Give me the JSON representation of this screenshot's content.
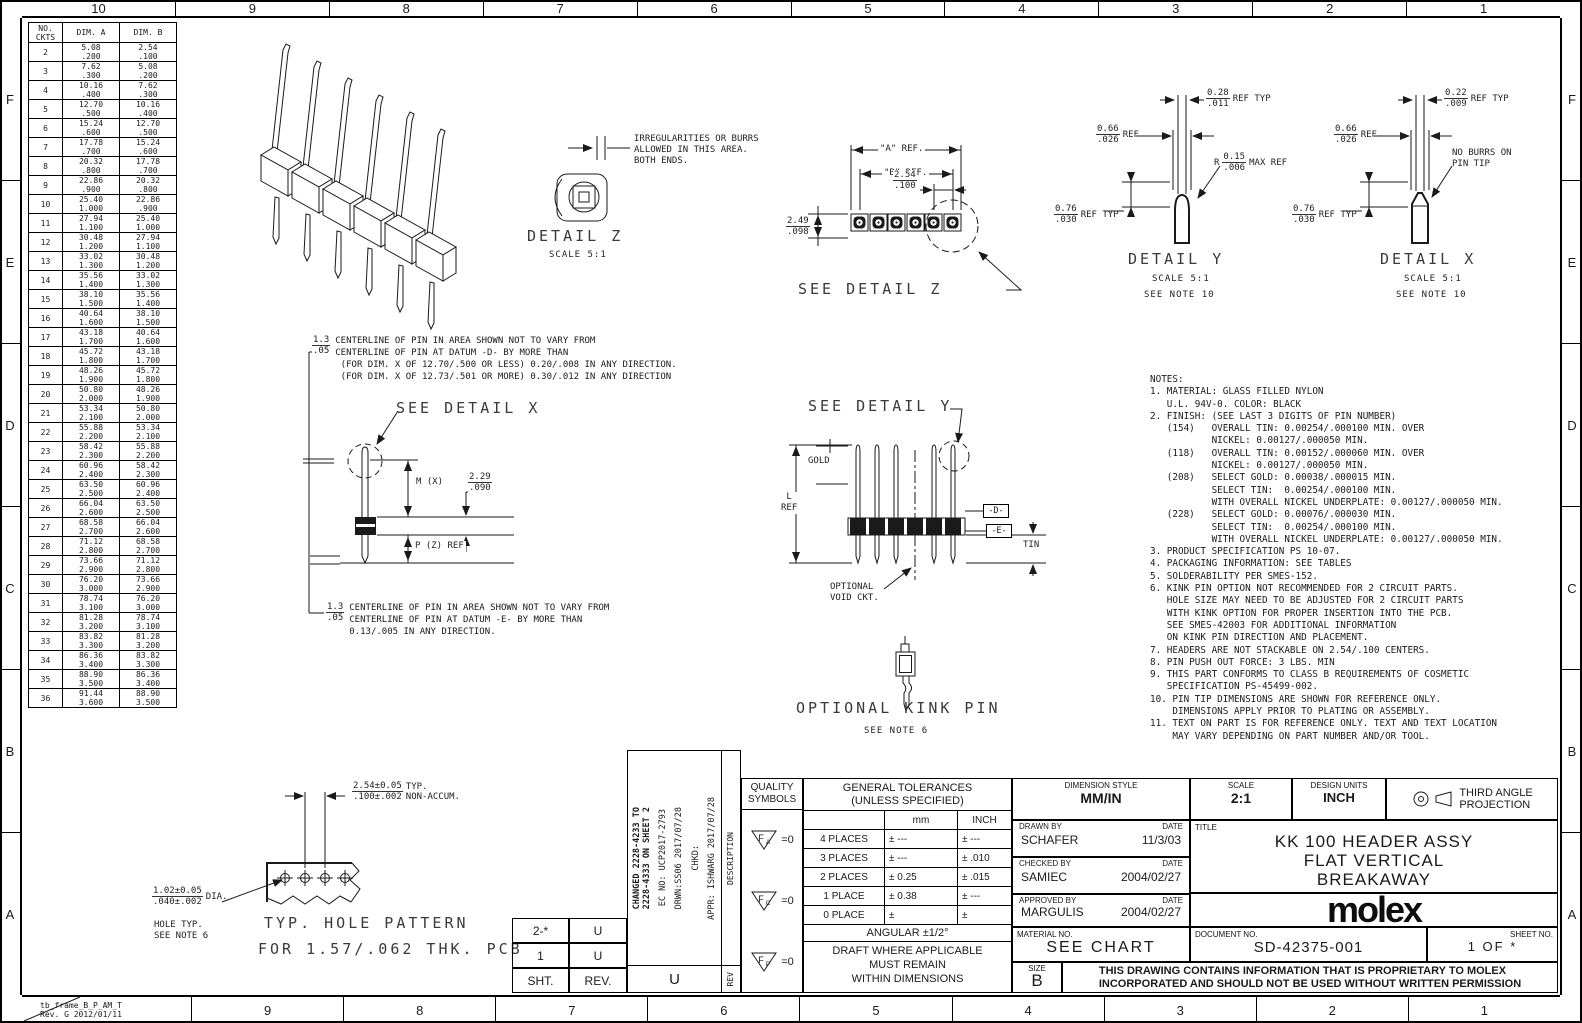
{
  "frame": {
    "top": [
      "10",
      "9",
      "8",
      "7",
      "6",
      "5",
      "4",
      "3",
      "2",
      "1"
    ],
    "bottom": [
      "9",
      "8",
      "7",
      "6",
      "5",
      "4",
      "3",
      "2",
      "1"
    ],
    "side": [
      "F",
      "E",
      "D",
      "C",
      "B",
      "A"
    ],
    "stamp": "tb_frame_B_P_AM_T\nRev. G 2012/01/11"
  },
  "circuits_table": {
    "col_ckts": "NO.\nCKTS",
    "col_a": "DIM. A",
    "col_b": "DIM. B",
    "rows": [
      [
        "2",
        "5.08",
        ".200",
        "2.54",
        ".100"
      ],
      [
        "3",
        "7.62",
        ".300",
        "5.08",
        ".200"
      ],
      [
        "4",
        "10.16",
        ".400",
        "7.62",
        ".300"
      ],
      [
        "5",
        "12.70",
        ".500",
        "10.16",
        ".400"
      ],
      [
        "6",
        "15.24",
        ".600",
        "12.70",
        ".500"
      ],
      [
        "7",
        "17.78",
        ".700",
        "15.24",
        ".600"
      ],
      [
        "8",
        "20.32",
        ".800",
        "17.78",
        ".700"
      ],
      [
        "9",
        "22.86",
        ".900",
        "20.32",
        ".800"
      ],
      [
        "10",
        "25.40",
        "1.000",
        "22.86",
        ".900"
      ],
      [
        "11",
        "27.94",
        "1.100",
        "25.40",
        "1.000"
      ],
      [
        "12",
        "30.48",
        "1.200",
        "27.94",
        "1.100"
      ],
      [
        "13",
        "33.02",
        "1.300",
        "30.48",
        "1.200"
      ],
      [
        "14",
        "35.56",
        "1.400",
        "33.02",
        "1.300"
      ],
      [
        "15",
        "38.10",
        "1.500",
        "35.56",
        "1.400"
      ],
      [
        "16",
        "40.64",
        "1.600",
        "38.10",
        "1.500"
      ],
      [
        "17",
        "43.18",
        "1.700",
        "40.64",
        "1.600"
      ],
      [
        "18",
        "45.72",
        "1.800",
        "43.18",
        "1.700"
      ],
      [
        "19",
        "48.26",
        "1.900",
        "45.72",
        "1.800"
      ],
      [
        "20",
        "50.80",
        "2.000",
        "48.26",
        "1.900"
      ],
      [
        "21",
        "53.34",
        "2.100",
        "50.80",
        "2.000"
      ],
      [
        "22",
        "55.88",
        "2.200",
        "53.34",
        "2.100"
      ],
      [
        "23",
        "58.42",
        "2.300",
        "55.88",
        "2.200"
      ],
      [
        "24",
        "60.96",
        "2.400",
        "58.42",
        "2.300"
      ],
      [
        "25",
        "63.50",
        "2.500",
        "60.96",
        "2.400"
      ],
      [
        "26",
        "66.04",
        "2.600",
        "63.50",
        "2.500"
      ],
      [
        "27",
        "68.58",
        "2.700",
        "66.04",
        "2.600"
      ],
      [
        "28",
        "71.12",
        "2.800",
        "68.58",
        "2.700"
      ],
      [
        "29",
        "73.66",
        "2.900",
        "71.12",
        "2.800"
      ],
      [
        "30",
        "76.20",
        "3.000",
        "73.66",
        "2.900"
      ],
      [
        "31",
        "78.74",
        "3.100",
        "76.20",
        "3.000"
      ],
      [
        "32",
        "81.28",
        "3.200",
        "78.74",
        "3.100"
      ],
      [
        "33",
        "83.82",
        "3.300",
        "81.28",
        "3.200"
      ],
      [
        "34",
        "86.36",
        "3.400",
        "83.82",
        "3.300"
      ],
      [
        "35",
        "88.90",
        "3.500",
        "86.36",
        "3.400"
      ],
      [
        "36",
        "91.44",
        "3.600",
        "88.90",
        "3.500"
      ]
    ]
  },
  "detail_z": {
    "title": "DETAIL Z",
    "scale": "SCALE 5:1",
    "burr_note": "IRREGULARITIES OR BURRS\nALLOWED IN THIS AREA.\nBOTH ENDS."
  },
  "top_view": {
    "a_ref": "\"A\" REF.",
    "b_ref": "\"B\" REF.",
    "pitch_mm": "2.54",
    "pitch_in": ".100",
    "height_mm": "2.49",
    "height_in": ".098",
    "see_detail_z": "SEE DETAIL Z"
  },
  "detail_y": {
    "title": "DETAIL Y",
    "scale": "SCALE 5:1",
    "note": "SEE NOTE 10",
    "tip_w_mm": "0.28",
    "tip_w_in": ".011",
    "tip_w_suffix": "REF TYP",
    "shaft_w_mm": "0.66",
    "shaft_w_in": ".026",
    "shaft_w_suffix": "REF",
    "radius_prefix": "R",
    "radius_mm": "0.15",
    "radius_in": ".006",
    "radius_suffix": "MAX REF",
    "plate_mm": "0.76",
    "plate_in": ".030",
    "plate_suffix": "REF TYP"
  },
  "detail_x": {
    "title": "DETAIL X",
    "scale": "SCALE 5:1",
    "note": "SEE NOTE 10",
    "tip_w_mm": "0.22",
    "tip_w_in": ".009",
    "tip_w_suffix": "REF TYP",
    "shaft_w_mm": "0.66",
    "shaft_w_in": ".026",
    "shaft_w_suffix": "REF",
    "burr_note": "NO BURRS ON\nPIN TIP",
    "plate_mm": "0.76",
    "plate_in": ".030",
    "plate_suffix": "REF TYP"
  },
  "datum_note_top": {
    "tol_mm": "1.3",
    "tol_in": ".05",
    "lines": "CENTERLINE OF PIN IN AREA SHOWN NOT TO VARY FROM\nCENTERLINE OF PIN AT DATUM -D- BY MORE THAN\n (FOR DIM. X OF 12.70/.500 OR LESS) 0.20/.008 IN ANY DIRECTION.\n (FOR DIM. X OF 12.73/.501 OR MORE) 0.30/.012 IN ANY DIRECTION"
  },
  "datum_note_bottom": {
    "tol_mm": "1.3",
    "tol_in": ".05",
    "lines": "CENTERLINE OF PIN IN AREA SHOWN NOT TO VARY FROM\nCENTERLINE OF PIN AT DATUM -E- BY MORE THAN\n0.13/.005 IN ANY DIRECTION."
  },
  "pin_side": {
    "see_detail_x": "SEE DETAIL X",
    "m_label": "M (X)",
    "body_mm": "2.29",
    "body_in": ".090",
    "p_label": "P (Z) REF"
  },
  "header_side": {
    "see_detail_y": "SEE DETAIL Y",
    "gold": "GOLD",
    "l_ref": "L\nREF",
    "datum_d": "-D-",
    "datum_e": "-E-",
    "tin": "TIN",
    "void_note": "OPTIONAL\nVOID CKT."
  },
  "kink": {
    "title": "OPTIONAL KINK PIN",
    "note": "SEE NOTE 6"
  },
  "hole_pattern": {
    "pitch_mm": "2.54±0.05",
    "pitch_in": ".100±.002",
    "pitch_suffix": "TYP.\nNON-ACCUM.",
    "dia_mm": "1.02±0.05",
    "dia_in": ".040±.002",
    "dia_suffix": "DIA.",
    "hole_note": "HOLE TYP.\nSEE NOTE 6",
    "caption_1": "TYP. HOLE  PATTERN",
    "caption_2": "FOR 1.57/.062 THK. PCB"
  },
  "notes": {
    "lines": [
      "NOTES:",
      "1. MATERIAL: GLASS FILLED NYLON",
      "   U.L. 94V-0. COLOR: BLACK",
      "2. FINISH: (SEE LAST 3 DIGITS OF PIN NUMBER)",
      "   (154)   OVERALL TIN: 0.00254/.000100 MIN. OVER",
      "           NICKEL: 0.00127/.000050 MIN.",
      "   (118)   OVERALL TIN: 0.00152/.000060 MIN. OVER",
      "           NICKEL: 0.00127/.000050 MIN.",
      "   (208)   SELECT GOLD: 0.00038/.000015 MIN.",
      "           SELECT TIN:  0.00254/.000100 MIN.",
      "           WITH OVERALL NICKEL UNDERPLATE: 0.00127/.000050 MIN.",
      "   (228)   SELECT GOLD: 0.00076/.000030 MIN.",
      "           SELECT TIN:  0.00254/.000100 MIN.",
      "           WITH OVERALL NICKEL UNDERPLATE: 0.00127/.000050 MIN.",
      "3. PRODUCT SPECIFICATION PS 10-07.",
      "4. PACKAGING INFORMATION: SEE TABLES",
      "5. SOLDERABILITY PER SMES-152.",
      "6. KINK PIN OPTION NOT RECOMMENDED FOR 2 CIRCUIT PARTS.",
      "   HOLE SIZE MAY NEED TO BE ADJUSTED FOR 2 CIRCUIT PARTS",
      "   WITH KINK OPTION FOR PROPER INSERTION INTO THE PCB.",
      "   SEE SMES-42003 FOR ADDITIONAL INFORMATION",
      "   ON KINK PIN DIRECTION AND PLACEMENT.",
      "7. HEADERS ARE NOT STACKABLE ON 2.54/.100 CENTERS.",
      "8. PIN PUSH OUT FORCE: 3 LBS. MIN",
      "9. THIS PART CONFORMS TO CLASS B REQUIREMENTS OF COSMETIC",
      "   SPECIFICATION PS-45499-002.",
      "10. PIN TIP DIMENSIONS ARE SHOWN FOR REFERENCE ONLY.",
      "    DIMENSIONS APPLY PRIOR TO PLATING OR ASSEMBLY.",
      "11. TEXT ON PART IS FOR REFERENCE ONLY. TEXT AND TEXT LOCATION",
      "    MAY VARY DEPENDING ON PART NUMBER AND/OR TOOL."
    ]
  },
  "rev_block": {
    "rows": [
      [
        "2-*",
        "U"
      ],
      [
        "1",
        "U"
      ]
    ],
    "sht_label": "SHT.",
    "rev_label": "REV.",
    "change_desc": "CHANGED 2228-4233 TO\n2228-4333 ON SHEET 2",
    "ec_no": "EC NO: UCP2017-2793",
    "drwn": "DRWN:SS06      2017/07/28",
    "chkd": "CHKD:",
    "appr": "APPR: ISHWARG  2017/07/28",
    "description_label": "DESCRIPTION",
    "rev_col_label": "REV",
    "current_rev": "U"
  },
  "quality": {
    "header": "QUALITY\nSYMBOLS",
    "symbols": [
      {
        "letter": "F",
        "sub": "A",
        "value": "=0"
      },
      {
        "letter": "F",
        "sub": "C",
        "value": "=0"
      },
      {
        "letter": "F",
        "sub": "P",
        "value": "=0"
      }
    ]
  },
  "tolerances": {
    "title": "GENERAL TOLERANCES",
    "subtitle": "(UNLESS SPECIFIED)",
    "col_mm": "mm",
    "col_inch": "INCH",
    "rows": [
      [
        "4 PLACES",
        "± ---",
        "± ---"
      ],
      [
        "3 PLACES",
        "± ---",
        "± .010"
      ],
      [
        "2 PLACES",
        "± 0.25",
        "± .015"
      ],
      [
        "1 PLACE",
        "± 0.38",
        "± ---"
      ],
      [
        "0 PLACE",
        "±",
        "±"
      ]
    ],
    "angular": "ANGULAR ±1/2°",
    "draft": "DRAFT WHERE APPLICABLE\nMUST REMAIN\nWITHIN DIMENSIONS"
  },
  "title_block": {
    "dimension_style_label": "DIMENSION STYLE",
    "dimension_style": "MM/IN",
    "scale_label": "SCALE",
    "scale": "2:1",
    "design_units_label": "DESIGN UNITS",
    "design_units": "INCH",
    "projection": "THIRD ANGLE\nPROJECTION",
    "drawn_by_label": "DRAWN BY",
    "date_label": "DATE",
    "drawn_by": "SCHAFER",
    "drawn_date": "11/3/03",
    "checked_by_label": "CHECKED BY",
    "checked_by": "SAMIEC",
    "checked_date": "2004/02/27",
    "approved_by_label": "APPROVED BY",
    "approved_by": "MARGULIS",
    "approved_date": "2004/02/27",
    "title_label": "TITLE",
    "title": "KK 100 HEADER ASSY\nFLAT VERTICAL\nBREAKAWAY",
    "material_label": "MATERIAL NO.",
    "material": "SEE CHART",
    "document_label": "DOCUMENT NO.",
    "document": "SD-42375-001",
    "sheet_label": "SHEET NO.",
    "sheet": "1 OF *",
    "size_label": "SIZE",
    "size": "B",
    "logo": "molex",
    "proprietary": "THIS DRAWING CONTAINS INFORMATION THAT IS PROPRIETARY TO MOLEX\nINCORPORATED AND SHOULD NOT BE USED WITHOUT WRITTEN PERMISSION"
  }
}
